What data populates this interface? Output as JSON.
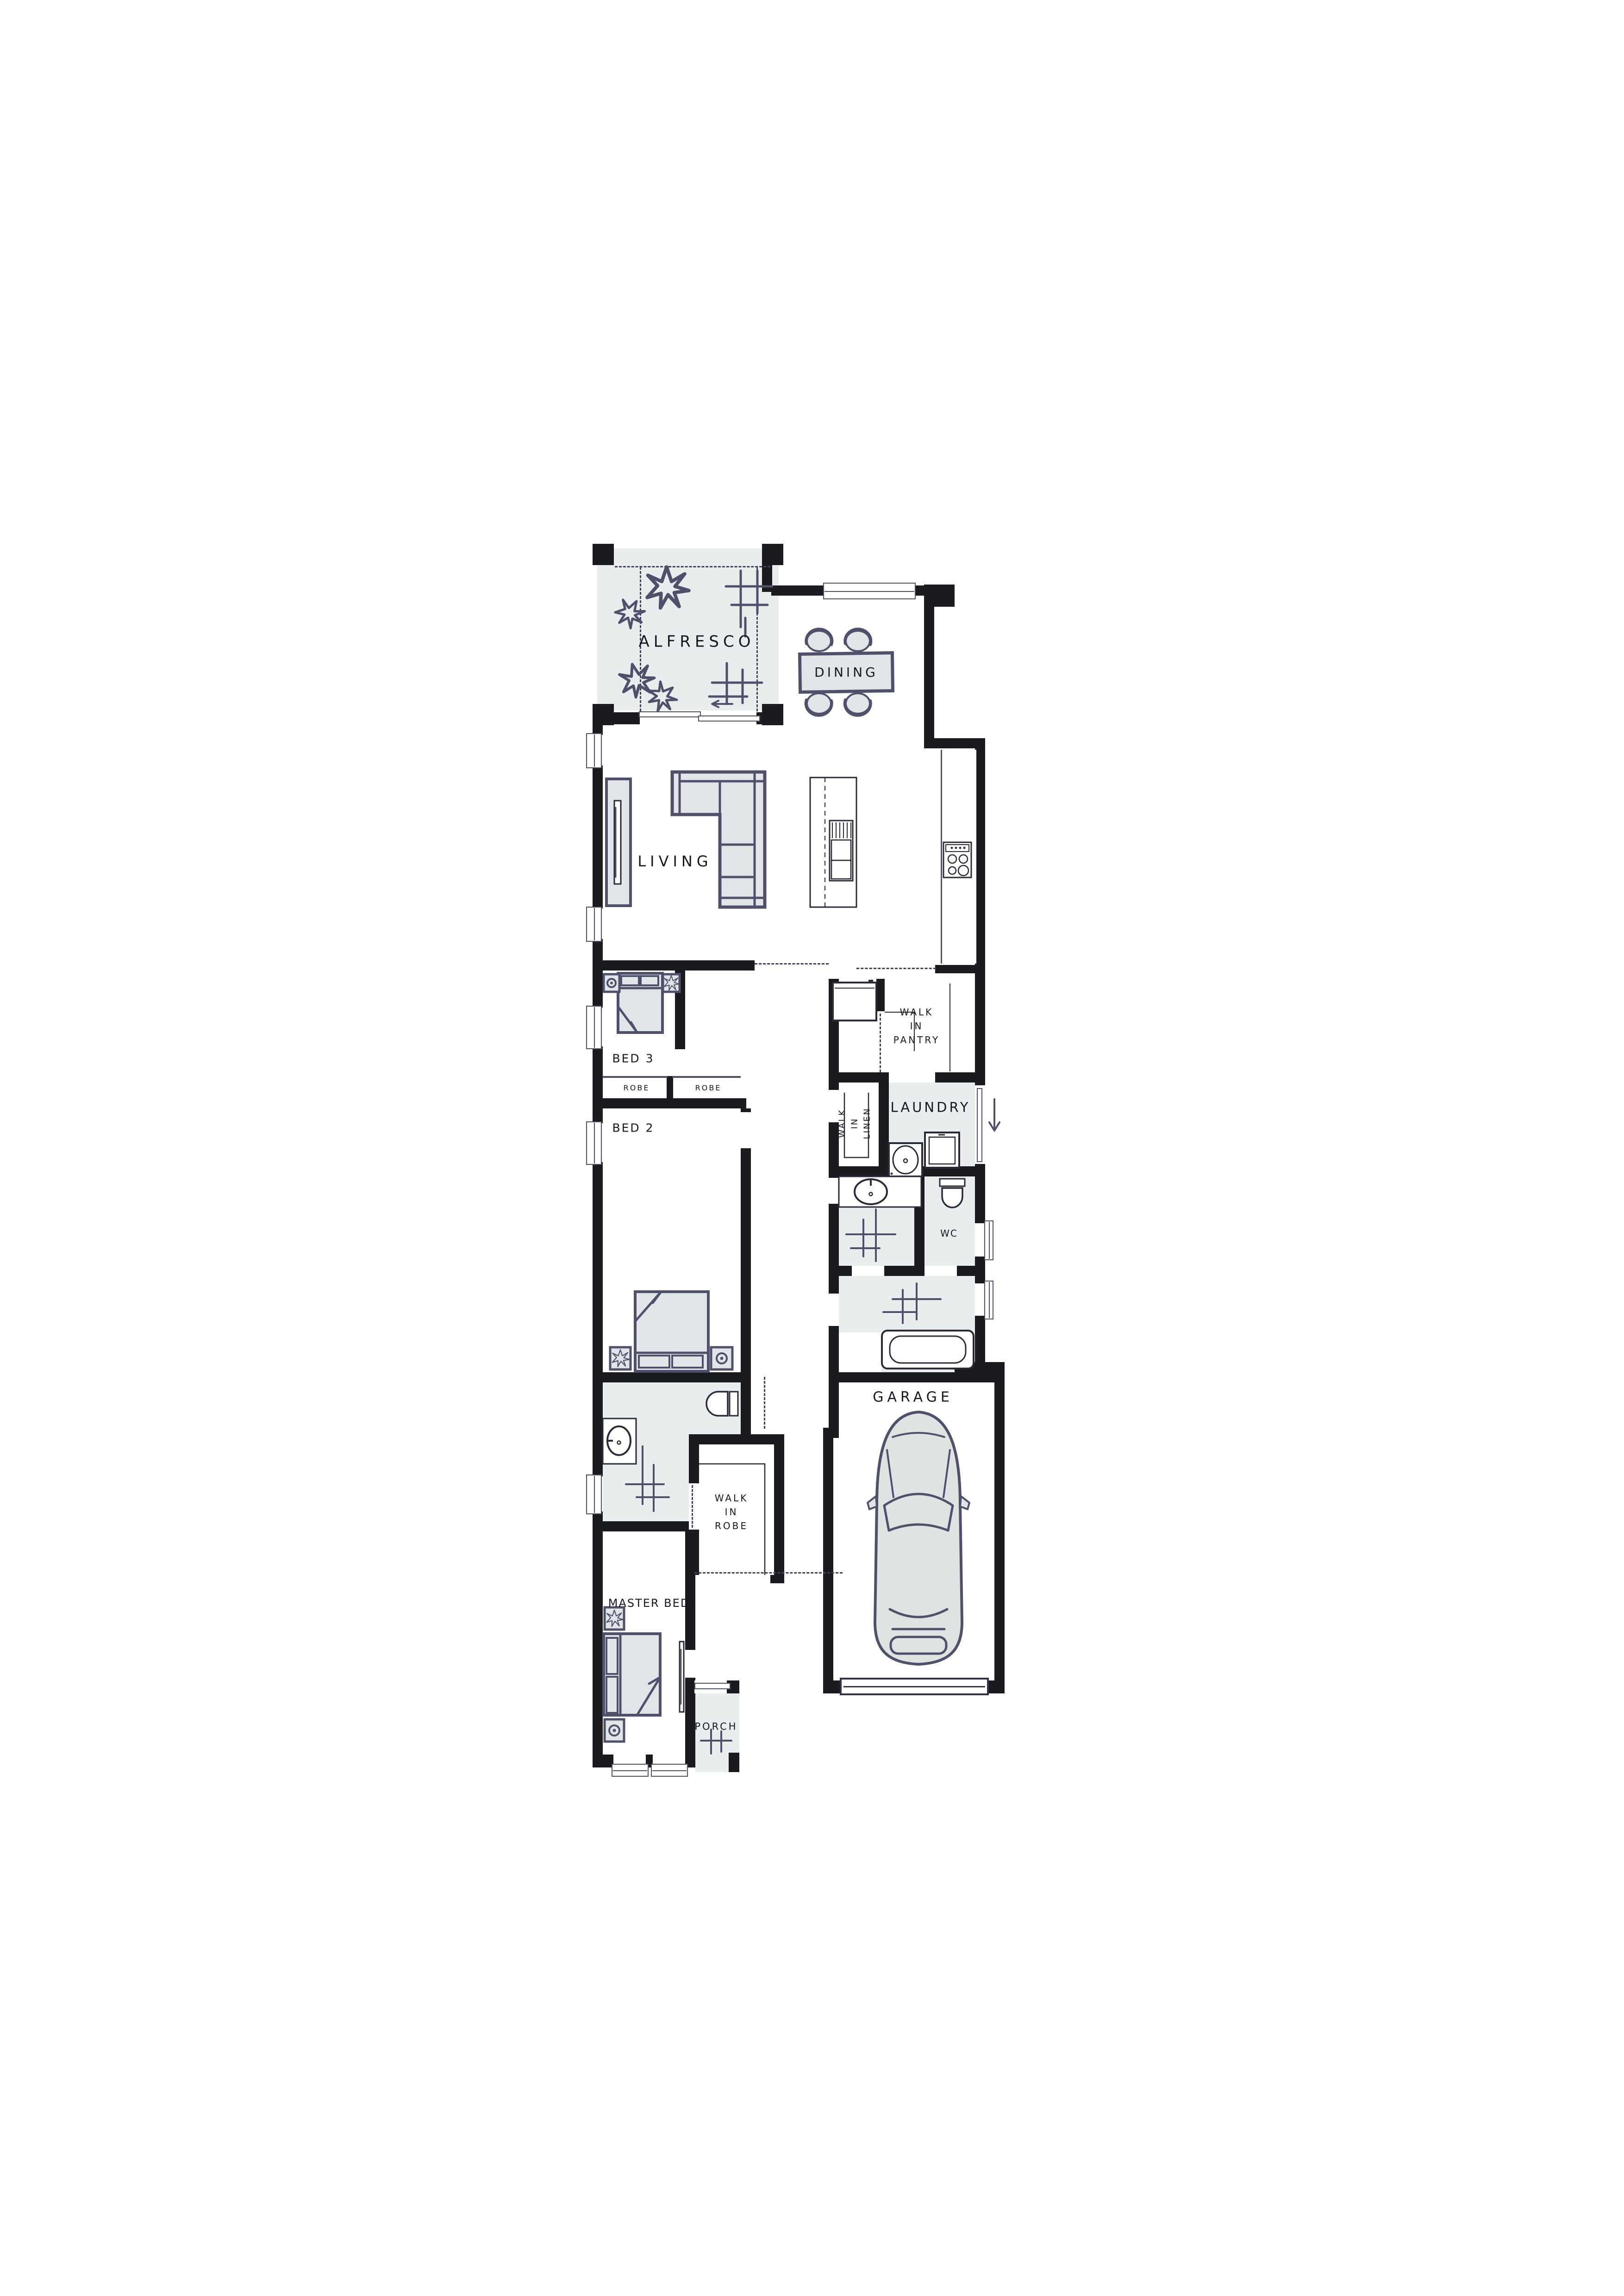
{
  "palette": {
    "wall": "#1b1b1f",
    "ink": "#50506a",
    "floor_tint": "#e9edee",
    "furniture_fill": "#e0e6e7",
    "label_color": "#17171f"
  },
  "rooms": {
    "alfresco": "ALFRESCO",
    "dining": "DINING",
    "living": "LIVING",
    "walk_in_pantry": "WALK\nIN\nPANTRY",
    "laundry": "LAUNDRY",
    "walk_in_linen": "WALK\nIN\nLINEN",
    "bed3": "BED 3",
    "robe_left": "ROBE",
    "robe_right": "ROBE",
    "bed2": "BED 2",
    "wc": "WC",
    "garage": "GARAGE",
    "walk_in_robe": "WALK\nIN\nROBE",
    "master_bed": "MASTER BED",
    "porch": "PORCH"
  }
}
